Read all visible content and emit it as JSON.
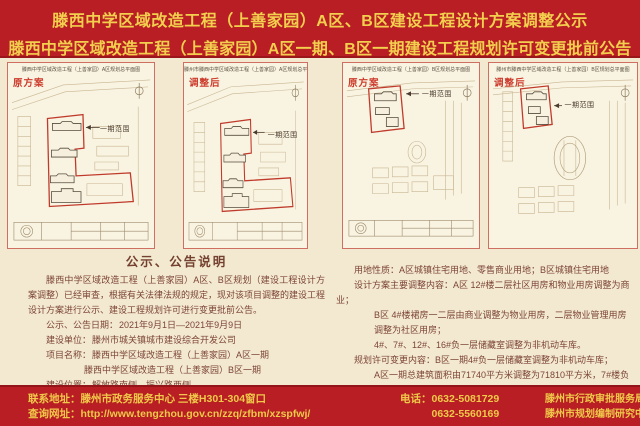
{
  "header": {
    "line1": "滕西中学区域改造工程（上善家园）A区、B区建设工程设计方案调整公示",
    "line2": "滕西中学区域改造工程（上善家园）A区一期、B区一期建设工程规划许可变更批前公告"
  },
  "panels": [
    {
      "map_title": "滕西中学区域改造工程（上善家园）A区规划总平面图",
      "tag": "原方案",
      "scope_label": "一期范围"
    },
    {
      "map_title": "滕州市滕西中学区域改造工程（上善家园）A区规划总平面图",
      "tag": "调整后",
      "scope_label": "一期范围"
    },
    {
      "map_title": "滕西中学区域改造工程（上善家园）B区规划总平面图",
      "tag": "原方案",
      "scope_label": "一期范围"
    },
    {
      "map_title": "滕州市滕西中学区域改造工程（上善家园）B区规划总平面图",
      "tag": "调整后",
      "scope_label": "一期范围"
    }
  ],
  "notice": {
    "heading": "公示、公告说明",
    "intro": "滕西中学区域改造工程（上善家园）A区、B区规划（建设工程设计方案调整）已经审查，根据有关法律法规的规定，现对该项目调整的建设工程设计方案进行公示、建设工程规划许可进行变更批前公告。",
    "fields": [
      {
        "label": "公示、公告日期：",
        "value": "2021年9月1日—2021年9月9日"
      },
      {
        "label": "建设单位：",
        "value": "滕州市城关镇城市建设综合开发公司"
      },
      {
        "label": "项目名称：",
        "value": "滕西中学区域改造工程（上善家园）A区一期"
      },
      {
        "label": "",
        "value": "滕西中学区域改造工程（上善家园）B区一期"
      },
      {
        "label": "建设位置：",
        "value": "解放路南侧、振兴路西侧"
      },
      {
        "label": "项目代码：",
        "value": "2019-370481-70-02-032378"
      }
    ]
  },
  "details": {
    "lines": [
      "用地性质：A区城镇住宅用地、零售商业用地；B区城镇住宅用地",
      "设计方案主要调整内容：A区 12#楼二层社区用房和物业用房调整为商业；",
      "B区 4#楼裙房一二层由商业调整为物业用房，二层物业管理用房调整为社区用房；",
      "4#、7#、12#、16#负一层储藏室调整为非机动车库。",
      "规划许可变更内容：B区一期4#负一层储藏室调整为非机动车库；",
      "A区一期总建筑面积由71740平方米调整为71810平方米，7#楼负一层储藏室调整为非机动车库。",
      "对本公示、公告如有异议，请在公示、公告期内以书面形式提出异议或听证申请，逾期不予受理，公示、公告期内如无异议，将按程序予以审批。"
    ]
  },
  "footer": {
    "address_label": "联系地址：",
    "address": "滕州市政务服务中心 三楼H301-304窗口",
    "website_label": "查询网址：",
    "website": "http://www.tengzhou.gov.cn/zzq/zfbm/xzspfwj/",
    "phone_label": "电话：",
    "phones": [
      "0632-5081729",
      "0632-5560169"
    ],
    "organizations": [
      "滕州市行政审批服务局",
      "滕州市规划编制研究中心"
    ],
    "seal": "监制"
  },
  "colors": {
    "banner_red": "#b81e23",
    "banner_yellow": "#f3cf4e",
    "body_cream": "#f3e9d1",
    "panel_paper": "#f9f3e1",
    "panel_border": "#cf6f62",
    "boundary_red": "#c03a2b",
    "text_brown": "#7c4437"
  }
}
